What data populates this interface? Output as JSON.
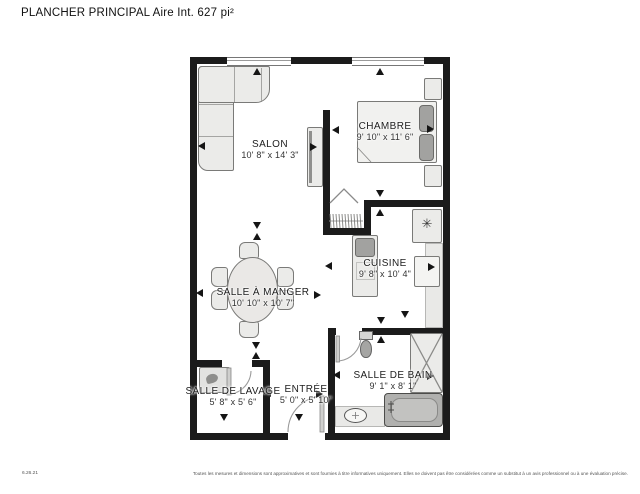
{
  "header": {
    "title": "PLANCHER PRINCIPAL Aire Int. 627 pi²"
  },
  "rooms": [
    {
      "id": "salon",
      "name": "SALON",
      "dims": "10' 8\" x 14' 3\""
    },
    {
      "id": "chambre",
      "name": "CHAMBRE",
      "dims": "9' 10\" x 11' 6\""
    },
    {
      "id": "cuisine",
      "name": "CUISINE",
      "dims": "9' 8\" x 10' 4\""
    },
    {
      "id": "salle_a_manger",
      "name": "SALLE À MANGER",
      "dims": "10' 10\" x 10' 7\""
    },
    {
      "id": "salle_de_lavage",
      "name": "SALLE DE LAVAGE",
      "dims": "5' 8\" x 5' 6\""
    },
    {
      "id": "entree",
      "name": "ENTRÉE",
      "dims": "5' 0\" x 5' 10\""
    },
    {
      "id": "salle_de_bain",
      "name": "SALLE DE BAIN",
      "dims": "9' 1\" x 8' 1\""
    }
  ],
  "icons": {
    "fridge_snowflake": "✳"
  },
  "colors": {
    "wall": "#1b1b1b",
    "furniture_fill": "#ebebe9",
    "appliance_gray": "#a2a2a0"
  },
  "footer": {
    "date": "6.26.21",
    "disclaimer": "Toutes les mesures et dimensions sont approximatives et sont fournies à titre informatives uniquement. Elles ne doivent pas être considérées comme un substitut à un avis professionnel ou à une évaluation précise."
  }
}
